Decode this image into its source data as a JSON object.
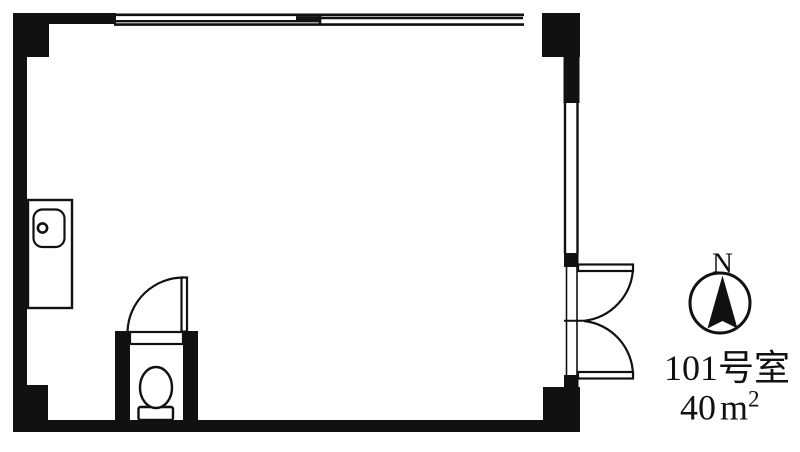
{
  "canvas": {
    "width": 800,
    "height": 452,
    "paper": "#ffffff",
    "ink": "#111111"
  },
  "plan": {
    "labels": {
      "room_number": "101号室",
      "area_value": "40",
      "area_unit_base": "m",
      "area_unit_exponent": "2",
      "compass_north": "N"
    }
  }
}
